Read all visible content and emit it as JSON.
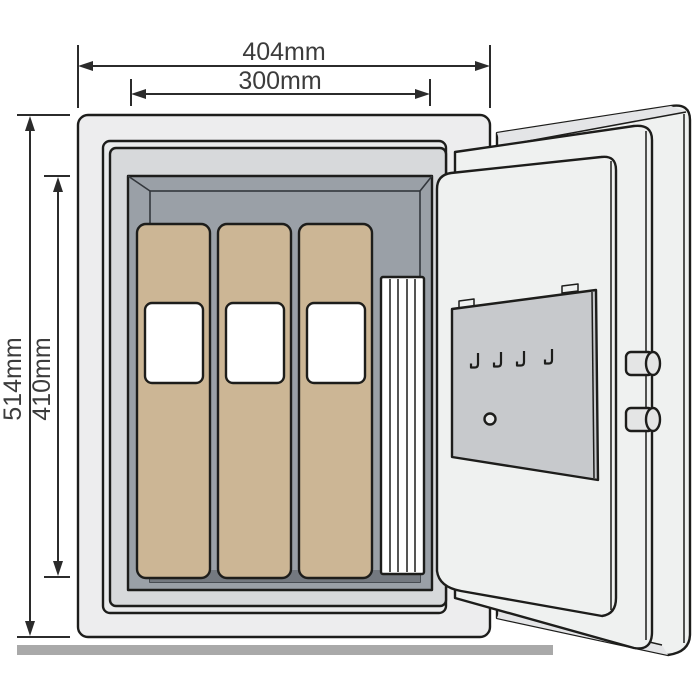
{
  "diagram": {
    "type": "technical-dimension-drawing",
    "subject": "Free-standing safe with open door: interior cavity holding three document binders and a stack of papers, door with key-rack panel, four key hooks and two locking bolts",
    "background": "#ffffff"
  },
  "dimensions": {
    "outer_width": {
      "label": "404mm",
      "orientation": "horizontal",
      "measures": "overall body width"
    },
    "inner_width": {
      "label": "300mm",
      "orientation": "horizontal",
      "measures": "interior cavity width"
    },
    "outer_height": {
      "label": "514mm",
      "orientation": "vertical",
      "measures": "overall body height"
    },
    "inner_height": {
      "label": "410mm",
      "orientation": "vertical",
      "measures": "interior cavity height"
    }
  },
  "parts": {
    "binder_count": 3,
    "key_hook_count": 4,
    "bolt_count": 2,
    "binder_label_windows": 3
  },
  "colors": {
    "outline": "#1d1d1b",
    "dim_line": "#2b2b2b",
    "dim_text": "#3c3c3c",
    "body": "#ededee",
    "frame_outer": "#eaebec",
    "frame_inner": "#d7d9db",
    "cavity": "#9aa0a7",
    "cavity_back": "#8d929a",
    "cavity_shadow": "#747980",
    "binder": "#ccb695",
    "binder_label": "#ffffff",
    "stack": "#ffffff",
    "door": "#eff1f0",
    "door_band": "#e4e5e7",
    "key_panel": "#c7c9cc",
    "clip": "#e8e9e9",
    "bolt": "#e4e5e5",
    "floor_bar": "#a9a9a9"
  }
}
